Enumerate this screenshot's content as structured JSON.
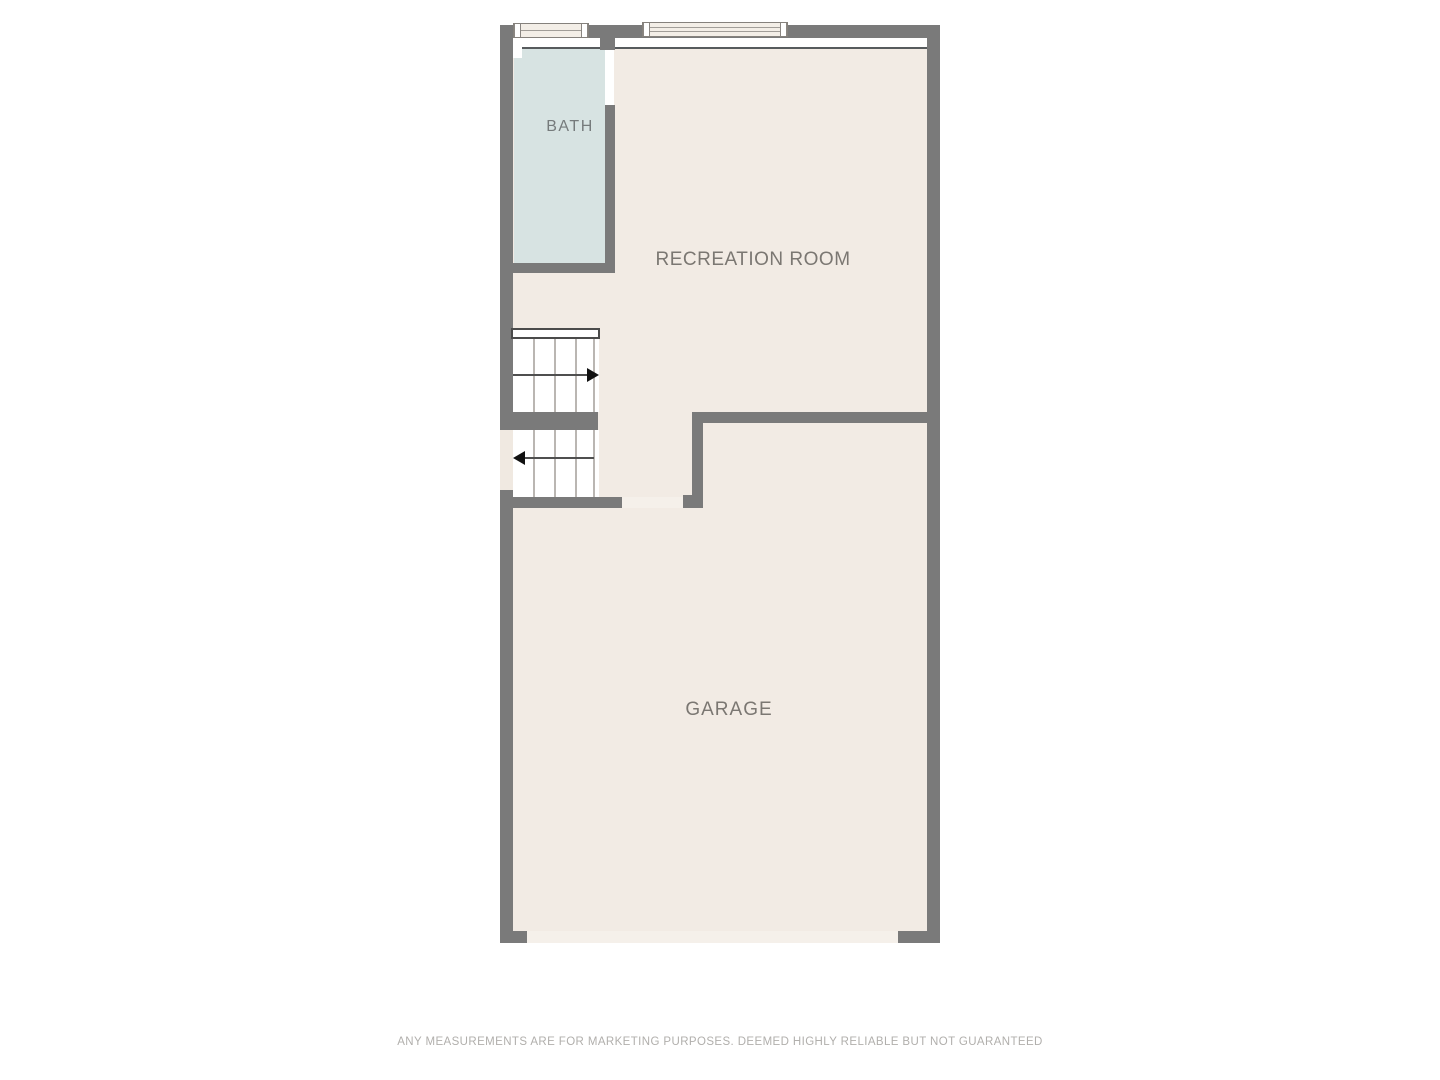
{
  "rooms": [
    {
      "id": "bath",
      "label": "BATH"
    },
    {
      "id": "recreation-room",
      "label": "RECREATION ROOM"
    },
    {
      "id": "garage",
      "label": "GARAGE"
    }
  ],
  "stairs": {
    "flights": 2,
    "upper_arrow_direction": "right",
    "lower_arrow_direction": "left"
  },
  "window_count": 2,
  "disclaimer": "ANY MEASUREMENTS ARE FOR MARKETING PURPOSES. DEEMED HIGHLY RELIABLE BUT NOT GUARANTEED",
  "palette": {
    "background": "#ffffff",
    "wall": "#7a7a7a",
    "floor": "#f2ebe4",
    "bath_fill": "#d7e3e2",
    "opening": "#f5f0ea",
    "stair_tread_line": "#bab6b2",
    "arrow": "#111111",
    "label_text": "#7b7772",
    "disclaimer_text": "#b1afac"
  }
}
